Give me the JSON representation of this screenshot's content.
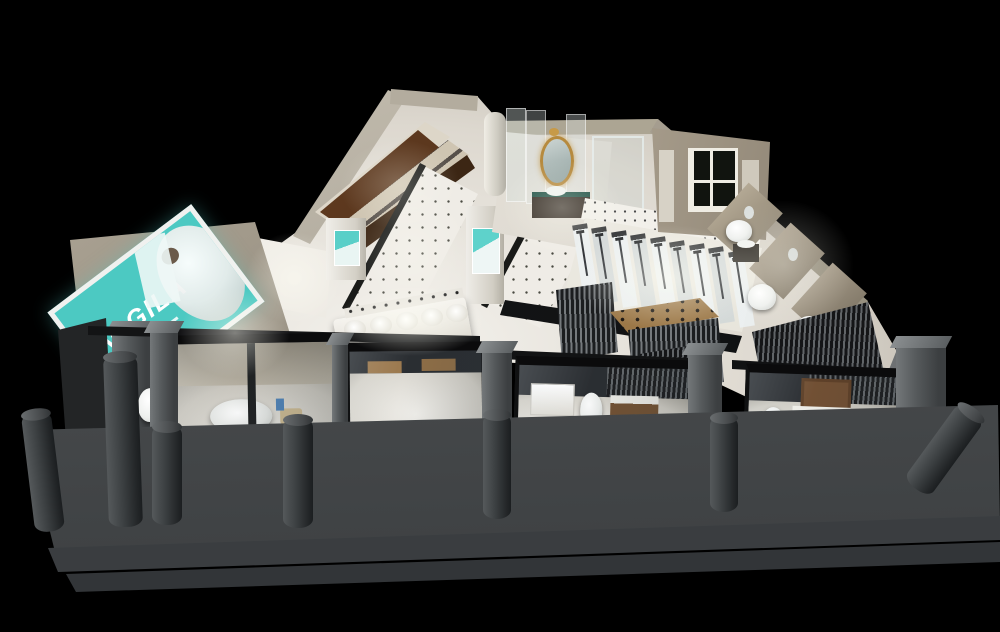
{
  "meta": {
    "title": "Isometric night render of a sanitary-ware showroom"
  },
  "sign": {
    "brand": "GGILA",
    "logo_mark": "triangle-A",
    "panel_color": "#4cc9c2",
    "frame_color": "#f0f1ef",
    "text_color": "#ffffff"
  },
  "palette": {
    "background": "#000000",
    "interior_floor": "#ece9e2",
    "wall_beige": "#b5ab9a",
    "wood_cabinet": "#5a3a22",
    "platform_gray": "#4b4e50",
    "step_gray": "#3a3d40",
    "bollard_gray": "#3c4042",
    "glass_frame_black": "#0b0b0c",
    "slat_dark": "#1b1d1f",
    "slat_light": "#75797c",
    "gold_mirror": "#b68a3e",
    "plant_green": "#3e7d3e",
    "teal_poster": "#59cfc8"
  },
  "regions": [
    {
      "name": "brand-sign",
      "label": "Teal billboard with triangle logo and model photo"
    },
    {
      "name": "left-wing-toilet-row",
      "label": "Row of display toilets along left wall"
    },
    {
      "name": "wood-cabinet-gallery",
      "label": "Dark wood vanity cabinets with sinks, upper-left"
    },
    {
      "name": "dotted-tile-corridors",
      "label": "White tile floors with dot inlays"
    },
    {
      "name": "basin-counter",
      "label": "Counter with five round wash basins and faucet shelf"
    },
    {
      "name": "poster-towers",
      "label": "White towers with teal product posters"
    },
    {
      "name": "luxury-suite",
      "label": "Room with gold baroque mirror, dark vanity, glass shower"
    },
    {
      "name": "shower-gallery",
      "label": "Rows of glass shower columns on lit plinth"
    },
    {
      "name": "slat-partitions",
      "label": "Vertical wood-slat partition walls"
    },
    {
      "name": "window-room",
      "label": "Back-right room with white french window"
    },
    {
      "name": "right-wall-vignettes",
      "label": "Bathroom vignettes with toilets and marble partitions"
    },
    {
      "name": "glass-room-bathtub",
      "label": "Storefront room with freestanding bathtub"
    },
    {
      "name": "glass-room-vanity",
      "label": "Storefront room with vanities, toilet and plant"
    },
    {
      "name": "glass-room-classic",
      "label": "Storefront room with wood vanity and mirror"
    },
    {
      "name": "front-walkway",
      "label": "Gray stone platform with steps"
    },
    {
      "name": "bollards",
      "label": "Seven dark cylindrical bollards"
    }
  ]
}
